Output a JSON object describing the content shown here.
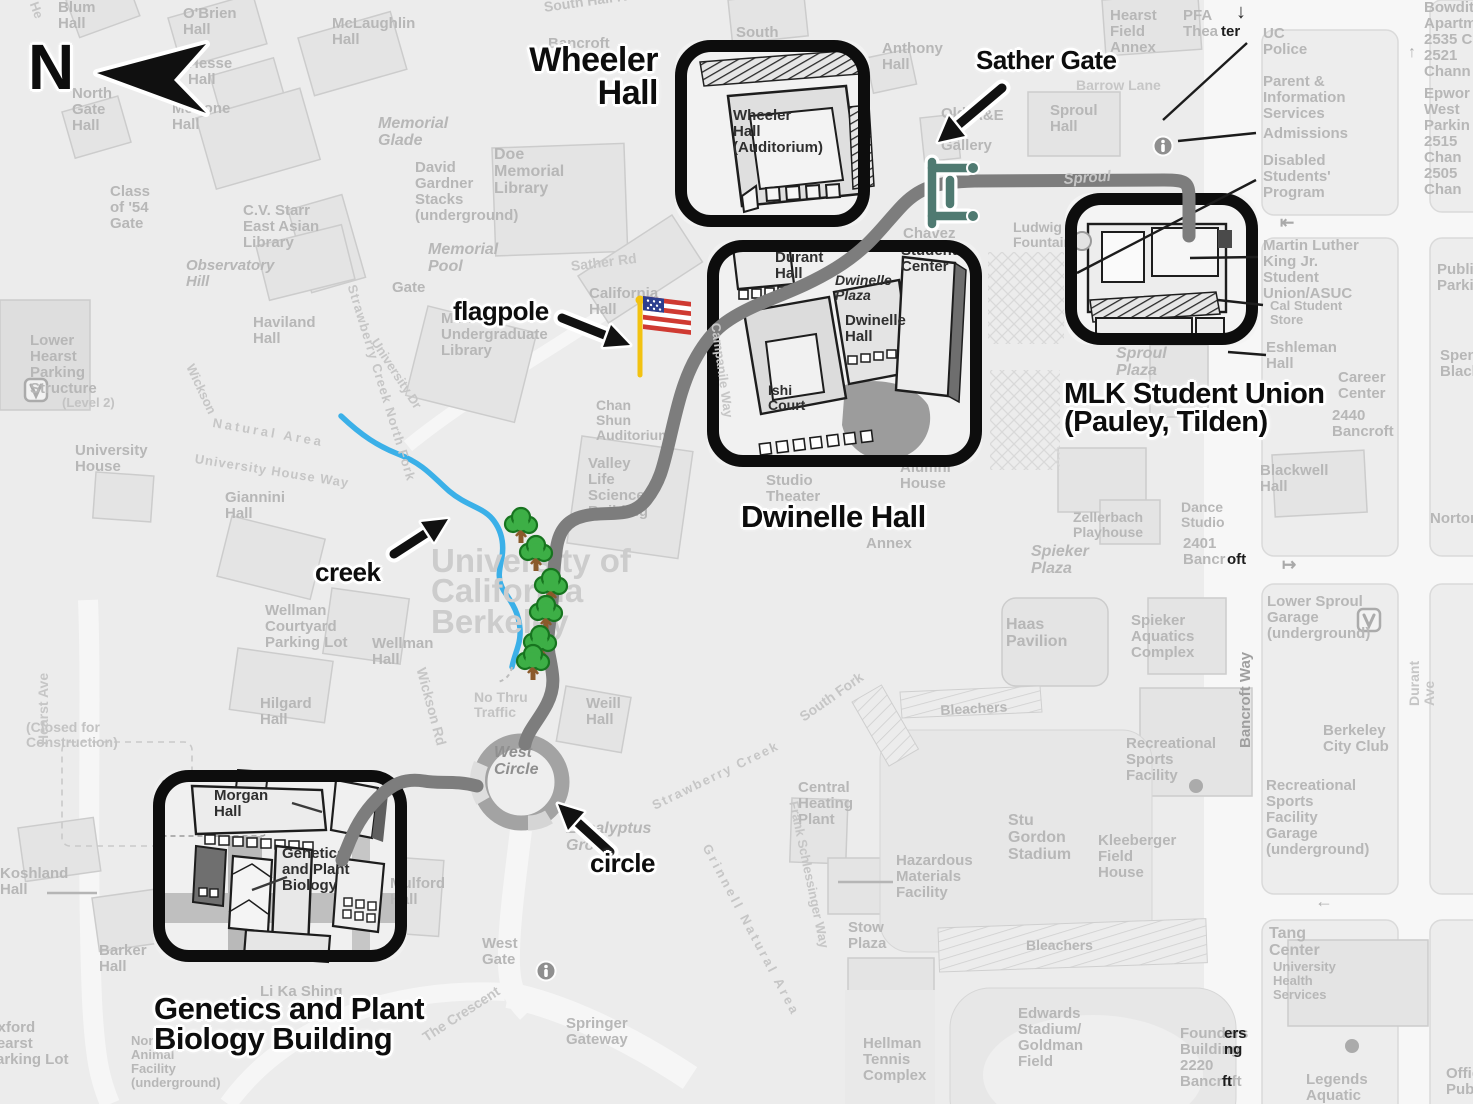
{
  "colors": {
    "bg": "#ececec",
    "label": "#b7b7b7",
    "annotation": "#0d0d0d",
    "highlight": "#0d0d0d",
    "route": "#7d7d7d",
    "creek": "#3bb0e8",
    "tree": "#3daf46",
    "tree_dark": "#17741f",
    "trunk": "#8a5a2b",
    "pole": "#f2c211",
    "flag_red": "#cf3a32",
    "flag_blue": "#2d3f8f",
    "gate": "#4f7a71"
  },
  "compass": {
    "letter": "N"
  },
  "annotations": [
    {
      "n": "compass-letter",
      "t": "N",
      "x": 28,
      "y": 36,
      "s": 64
    },
    {
      "n": "wheeler-hall-label",
      "t": "Wheeler\nHall",
      "x": 658,
      "y": 44,
      "s": 34,
      "a": "r"
    },
    {
      "n": "sather-gate-label",
      "t": "Sather Gate",
      "x": 976,
      "y": 48,
      "s": 26
    },
    {
      "n": "flagpole-label",
      "t": "flagpole",
      "x": 453,
      "y": 299,
      "s": 26
    },
    {
      "n": "mlk-student-union-label",
      "t": "MLK Student Union\n(Pauley, Tilden)",
      "x": 1064,
      "y": 380,
      "s": 29
    },
    {
      "n": "dwinelle-hall-label",
      "t": "Dwinelle Hall",
      "x": 741,
      "y": 502,
      "s": 31
    },
    {
      "n": "creek-label",
      "t": "creek",
      "x": 315,
      "y": 560,
      "s": 26
    },
    {
      "n": "circle-label",
      "t": "circle",
      "x": 590,
      "y": 851,
      "s": 26
    },
    {
      "n": "genetics-building-label",
      "t": "Genetics and Plant\nBiology Building",
      "x": 154,
      "y": 994,
      "s": 31
    }
  ],
  "highlight_boxes": [
    {
      "name": "wheeler-hall-box",
      "x": 675,
      "y": 40,
      "w": 195,
      "h": 187
    },
    {
      "name": "dwinelle-hall-box",
      "x": 707,
      "y": 240,
      "w": 275,
      "h": 227
    },
    {
      "name": "mlk-student-union-box",
      "x": 1065,
      "y": 193,
      "w": 193,
      "h": 152
    },
    {
      "name": "genetics-plant-biology-box",
      "x": 153,
      "y": 770,
      "w": 254,
      "h": 192
    }
  ],
  "map_labels": [
    {
      "t": "He",
      "x": 40,
      "y": 0,
      "r": 70,
      "s": 13,
      "c": "#c6c6c6"
    },
    {
      "t": "Blum\nHall",
      "x": 58,
      "y": 0
    },
    {
      "t": "O'Brien\nHall",
      "x": 183,
      "y": 6
    },
    {
      "t": "McLaughlin\nHall",
      "x": 332,
      "y": 16
    },
    {
      "t": "Hesse\nHall",
      "x": 188,
      "y": 56
    },
    {
      "t": "North\nGate\nHall",
      "x": 72,
      "y": 86
    },
    {
      "t": "McCone\nHall",
      "x": 172,
      "y": 101
    },
    {
      "t": "Class\nof '54\nGate",
      "x": 110,
      "y": 184
    },
    {
      "t": "C.V. Starr\nEast Asian\nLibrary",
      "x": 243,
      "y": 203
    },
    {
      "t": "Observatory\nHill",
      "x": 186,
      "y": 258,
      "i": 1
    },
    {
      "t": "Memorial\nGlade",
      "x": 378,
      "y": 115,
      "i": 1,
      "s": 16
    },
    {
      "t": "David\nGardner\nStacks\n(underground)",
      "x": 415,
      "y": 160
    },
    {
      "t": "Memorial\nPool",
      "x": 428,
      "y": 241,
      "i": 1,
      "s": 16
    },
    {
      "t": "South Hall Rd",
      "x": 543,
      "y": 0,
      "r": -8,
      "s": 14,
      "c": "#c2c2c2"
    },
    {
      "t": "Bancroft",
      "x": 548,
      "y": 36
    },
    {
      "t": "South",
      "x": 736,
      "y": 25
    },
    {
      "t": "Anthony\nHall",
      "x": 882,
      "y": 41
    },
    {
      "t": "Old\nArt\nGallery",
      "x": 941,
      "y": 106
    },
    {
      "t": "A&E",
      "x": 972,
      "y": 108
    },
    {
      "t": "Sproul\nHall",
      "x": 1050,
      "y": 103
    },
    {
      "t": "Barrow Lane",
      "x": 1076,
      "y": 78,
      "s": 14,
      "c": "#c6c6c6"
    },
    {
      "t": "Hearst\nField\nAnnex",
      "x": 1110,
      "y": 8
    },
    {
      "t": "PFA\nThea",
      "x": 1183,
      "y": 8
    },
    {
      "t": "ter",
      "x": 1221,
      "y": 24,
      "c": "#1c1c1c"
    },
    {
      "t": "↓",
      "x": 1236,
      "y": 2,
      "s": 20,
      "c": "#2a2a2a"
    },
    {
      "t": "UC\nPolice",
      "x": 1263,
      "y": 26
    },
    {
      "t": "Parent &\nInformation\nServices",
      "x": 1263,
      "y": 74
    },
    {
      "t": "Admissions",
      "x": 1263,
      "y": 126
    },
    {
      "t": "Disabled\nStudents'\nProgram",
      "x": 1263,
      "y": 153
    },
    {
      "t": "⇤",
      "x": 1280,
      "y": 214,
      "s": 17,
      "c": "#a9a9a9"
    },
    {
      "t": "Martin Luther\nKing Jr.\nStudent\nUnion/ASUC",
      "x": 1263,
      "y": 238
    },
    {
      "t": "Cal Student\nStore",
      "x": 1270,
      "y": 299,
      "s": 13
    },
    {
      "t": "Eshleman\nHall",
      "x": 1266,
      "y": 340
    },
    {
      "t": "Career\nCenter",
      "x": 1338,
      "y": 370
    },
    {
      "t": "2440\nBancroft",
      "x": 1332,
      "y": 408
    },
    {
      "t": "Blackwell\nHall",
      "x": 1260,
      "y": 463
    },
    {
      "t": "Norton",
      "x": 1430,
      "y": 511
    },
    {
      "t": "Dance\nStudio",
      "x": 1181,
      "y": 500,
      "s": 14
    },
    {
      "t": "2401\nBancr",
      "x": 1183,
      "y": 536
    },
    {
      "t": "oft",
      "x": 1227,
      "y": 552,
      "c": "#1c1c1c"
    },
    {
      "t": "↦",
      "x": 1282,
      "y": 556,
      "s": 17,
      "c": "#a9a9a9"
    },
    {
      "t": "Lower Sproul\nGarage\n(underground)",
      "x": 1267,
      "y": 594
    },
    {
      "t": "Durant Ave",
      "x": 1407,
      "y": 706,
      "r": -90,
      "s": 14,
      "c": "#c6c6c6"
    },
    {
      "t": "Berkeley\nCity Club",
      "x": 1323,
      "y": 723
    },
    {
      "t": "Recreational\nSports\nFacility\nGarage\n(underground)",
      "x": 1266,
      "y": 778
    },
    {
      "t": "Bancroft Way",
      "x": 1238,
      "y": 748,
      "r": -90,
      "s": 15,
      "c": "#9f9f9f"
    },
    {
      "t": "←",
      "x": 1315,
      "y": 892,
      "s": 18,
      "c": "#b0b0b0"
    },
    {
      "t": "Tang\nCenter",
      "x": 1269,
      "y": 925,
      "s": 16
    },
    {
      "t": "University\nHealth\nServices",
      "x": 1273,
      "y": 960,
      "s": 13
    },
    {
      "t": "Legends\nAquatic",
      "x": 1306,
      "y": 1072
    },
    {
      "t": "Offic\nPubli",
      "x": 1446,
      "y": 1066
    },
    {
      "t": "Founders\nBuilding\n2220\nBancroft",
      "x": 1180,
      "y": 1026
    },
    {
      "t": "ers\nng",
      "x": 1224,
      "y": 1026,
      "c": "#1c1c1c"
    },
    {
      "t": "ft",
      "x": 1222,
      "y": 1074,
      "c": "#1c1c1c"
    },
    {
      "t": "Bowditch\nApartme\n2535 Ch",
      "x": 1424,
      "y": 0
    },
    {
      "t": "↑",
      "x": 1408,
      "y": 44,
      "s": 16,
      "c": "#b0b0b0"
    },
    {
      "t": "2521\nChann",
      "x": 1424,
      "y": 48
    },
    {
      "t": "Epwor\nWest\nParkin",
      "x": 1424,
      "y": 86
    },
    {
      "t": "2515\nChan",
      "x": 1424,
      "y": 134
    },
    {
      "t": "2505\nChan",
      "x": 1424,
      "y": 166
    },
    {
      "t": "Public\nParkin",
      "x": 1437,
      "y": 262
    },
    {
      "t": "Spens\nBlack",
      "x": 1440,
      "y": 348
    },
    {
      "t": "Sproul\nPlaza",
      "x": 1116,
      "y": 345,
      "i": 1,
      "s": 16
    },
    {
      "t": "Ludwig\nFountain",
      "x": 1013,
      "y": 220,
      "s": 14
    },
    {
      "t": "Chávez",
      "x": 903,
      "y": 226
    },
    {
      "t": "Zellerbach\nPlayhouse",
      "x": 1073,
      "y": 510,
      "s": 14
    },
    {
      "t": "Spieker\nPlaza",
      "x": 1031,
      "y": 543,
      "i": 1,
      "s": 16
    },
    {
      "t": "Haas\nPavilion",
      "x": 1006,
      "y": 616,
      "s": 16
    },
    {
      "t": "Spieker\nAquatics\nComplex",
      "x": 1131,
      "y": 613
    },
    {
      "t": "Recreational\nSports\nFacility",
      "x": 1126,
      "y": 736
    },
    {
      "t": "Kleeberger\nField\nHouse",
      "x": 1098,
      "y": 833
    },
    {
      "t": "Stu\nGordon\nStadium",
      "x": 1008,
      "y": 812,
      "s": 16
    },
    {
      "t": "Bleachers",
      "x": 940,
      "y": 703,
      "s": 14,
      "r": -3
    },
    {
      "t": "Bleachers",
      "x": 1026,
      "y": 938,
      "s": 14
    },
    {
      "t": "Central\nHeating\nPlant",
      "x": 798,
      "y": 780
    },
    {
      "t": "Stow\nPlaza",
      "x": 848,
      "y": 920
    },
    {
      "t": "Hazardous\nMaterials\nFacility",
      "x": 896,
      "y": 853
    },
    {
      "t": "Hellman\nTennis\nComplex",
      "x": 863,
      "y": 1036
    },
    {
      "t": "Edwards\nStadium/\nGoldman\nField",
      "x": 1018,
      "y": 1006
    },
    {
      "t": "South Fork",
      "x": 797,
      "y": 712,
      "r": -35,
      "s": 14,
      "c": "#c6c6c6"
    },
    {
      "t": "Frank Schlessinger Way",
      "x": 800,
      "y": 800,
      "r": 78,
      "s": 13,
      "c": "#c6c6c6"
    },
    {
      "t": "Grinnell Natural Area",
      "x": 712,
      "y": 842,
      "r": 62,
      "s": 13,
      "c": "#c6c6c6",
      "ls": 3
    },
    {
      "t": "Strawberry Creek",
      "x": 650,
      "y": 800,
      "r": -26,
      "s": 13,
      "c": "#c6c6c6",
      "ls": 2
    },
    {
      "t": "Eucalyptus\nGrove",
      "x": 566,
      "y": 820,
      "i": 1,
      "s": 16
    },
    {
      "t": "West\nGate",
      "x": 482,
      "y": 936
    },
    {
      "t": "Springer\nGateway",
      "x": 566,
      "y": 1016
    },
    {
      "t": "The Crescent",
      "x": 420,
      "y": 1032,
      "r": -33,
      "s": 14,
      "c": "#c6c6c6"
    },
    {
      "t": "West\nCircle",
      "x": 494,
      "y": 744,
      "i": 1,
      "s": 16,
      "c": "#8f8f8f"
    },
    {
      "t": "Weill\nHall",
      "x": 586,
      "y": 696
    },
    {
      "t": "No Thru\nTraffic",
      "x": 474,
      "y": 690,
      "s": 14,
      "c": "#c3c3c3"
    },
    {
      "t": "Wickson Rd",
      "x": 428,
      "y": 666,
      "r": 75,
      "s": 14,
      "c": "#c6c6c6"
    },
    {
      "t": "Wellman\nHall",
      "x": 372,
      "y": 636
    },
    {
      "t": "Wellman\nCourtyard\nParking Lot",
      "x": 265,
      "y": 603
    },
    {
      "t": "Hilgard\nHall",
      "x": 260,
      "y": 696
    },
    {
      "t": "Giannini\nHall",
      "x": 225,
      "y": 490
    },
    {
      "t": "University\nHouse",
      "x": 75,
      "y": 443
    },
    {
      "t": "University House Way",
      "x": 196,
      "y": 452,
      "r": 9,
      "s": 13,
      "c": "#c6c6c6",
      "ls": 1
    },
    {
      "t": "Lower\nHearst\nParking\nStructure",
      "x": 30,
      "y": 333
    },
    {
      "t": "(Level 2)",
      "x": 62,
      "y": 396,
      "s": 13,
      "c": "#c3c3c3"
    },
    {
      "t": "Strawberry Creek North Fork",
      "x": 358,
      "y": 283,
      "r": 73,
      "s": 13,
      "c": "#c6c6c6",
      "ls": 1
    },
    {
      "t": "Wickson",
      "x": 196,
      "y": 362,
      "r": 65,
      "s": 13,
      "c": "#c6c6c6"
    },
    {
      "t": "Natural Area",
      "x": 214,
      "y": 416,
      "r": 10,
      "s": 13,
      "c": "#c6c6c6",
      "ls": 3
    },
    {
      "t": "Haviland\nHall",
      "x": 253,
      "y": 315
    },
    {
      "t": "University Dr",
      "x": 380,
      "y": 336,
      "r": 57,
      "s": 13,
      "c": "#c6c6c6"
    },
    {
      "t": "Gate",
      "x": 392,
      "y": 280
    },
    {
      "t": "Sather Rd",
      "x": 570,
      "y": 259,
      "r": -7,
      "s": 14,
      "c": "#c6c6c6"
    },
    {
      "t": "California\nHall",
      "x": 589,
      "y": 286
    },
    {
      "t": "Moffitt\nUndergraduate\nLibrary",
      "x": 441,
      "y": 311
    },
    {
      "t": "Doe\nMemorial\nLibrary",
      "x": 494,
      "y": 146,
      "s": 16
    },
    {
      "t": "Chan\nShun\nAuditorium",
      "x": 596,
      "y": 398,
      "s": 14
    },
    {
      "t": "Valley\nLife\nSciences\nBuilding",
      "x": 588,
      "y": 456
    },
    {
      "t": "Studio\nTheater",
      "x": 766,
      "y": 473
    },
    {
      "t": "Annex",
      "x": 866,
      "y": 536
    },
    {
      "t": "Alumni\nHouse",
      "x": 900,
      "y": 460
    },
    {
      "t": "Koshland\nHall",
      "x": 0,
      "y": 866
    },
    {
      "t": "Barker\nHall",
      "x": 99,
      "y": 943
    },
    {
      "t": "(Closed for\nConstruction)",
      "x": 26,
      "y": 720,
      "s": 14,
      "c": "#c3c3c3"
    },
    {
      "t": "Oxford\nHearst\nParking Lot",
      "x": -14,
      "y": 1020
    },
    {
      "t": "Northwest\nAnimal\nFacility\n(underground)",
      "x": 131,
      "y": 1034,
      "s": 13
    },
    {
      "t": "Hearst Ave",
      "x": 36,
      "y": 745,
      "r": -90,
      "s": 14,
      "c": "#c6c6c6"
    },
    {
      "t": "Li Ka Shing",
      "x": 260,
      "y": 984
    },
    {
      "t": "Mulford\nHall",
      "x": 390,
      "y": 876
    },
    {
      "t": "University of\nCalifornia\nBerkeley",
      "x": 431,
      "y": 546,
      "s": 33,
      "c": "#cccccc",
      "lh": 0.92
    },
    {
      "t": "Wheeler\nHall\n(Auditorium)",
      "x": 733,
      "y": 108,
      "c": "#2f2f2f"
    },
    {
      "t": "Durant\nHall",
      "x": 775,
      "y": 250,
      "c": "#2f2f2f"
    },
    {
      "t": "Dwinelle\nPlaza",
      "x": 835,
      "y": 273,
      "c": "#2f2f2f",
      "i": 1,
      "s": 14
    },
    {
      "t": "Dwinelle\nHall",
      "x": 845,
      "y": 313,
      "c": "#2f2f2f"
    },
    {
      "t": "Ishi\nCourt",
      "x": 768,
      "y": 383,
      "c": "#2f2f2f",
      "s": 14
    },
    {
      "t": "Student\nCenter",
      "x": 901,
      "y": 243,
      "c": "#2f2f2f"
    },
    {
      "t": "Morgan\nHall",
      "x": 214,
      "y": 788,
      "c": "#2f2f2f"
    },
    {
      "t": "Genetics\nand Plant\nBiology",
      "x": 282,
      "y": 846,
      "c": "#2f2f2f"
    }
  ],
  "map_labels_top": [
    {
      "t": "Sproul",
      "x": 1063,
      "y": 172,
      "i": 1,
      "r": -4,
      "s": 15,
      "c": "#c6c6c6"
    },
    {
      "t": "Campanile Way",
      "x": 722,
      "y": 322,
      "r": 82,
      "s": 13,
      "c": "#c6c6c6"
    }
  ],
  "leader_lines": [
    {
      "x1": 1247,
      "y1": 43,
      "x2": 1163,
      "y2": 120
    },
    {
      "x1": 1256,
      "y1": 133,
      "x2": 1178,
      "y2": 141
    },
    {
      "x1": 1256,
      "y1": 180,
      "x2": 1077,
      "y2": 273
    },
    {
      "x1": 1258,
      "y1": 257,
      "x2": 1190,
      "y2": 258
    },
    {
      "x1": 1263,
      "y1": 305,
      "x2": 1218,
      "y2": 300
    },
    {
      "x1": 1266,
      "y1": 355,
      "x2": 1228,
      "y2": 352
    },
    {
      "x1": 47,
      "y1": 893,
      "x2": 97,
      "y2": 893,
      "c": "#b5b5b5"
    },
    {
      "x1": 287,
      "y1": 877,
      "x2": 252,
      "y2": 890,
      "c": "#3a3a3a"
    },
    {
      "x1": 893,
      "y1": 882,
      "x2": 838,
      "y2": 882,
      "c": "#b5b5b5"
    },
    {
      "x1": 322,
      "y1": 812,
      "x2": 292,
      "y2": 803,
      "c": "#3a3a3a"
    }
  ],
  "trees": [
    [
      521,
      526
    ],
    [
      536,
      554
    ],
    [
      551,
      587
    ],
    [
      546,
      614
    ],
    [
      540,
      644
    ],
    [
      533,
      663
    ]
  ],
  "info_icons": [
    [
      1163,
      146
    ],
    [
      546,
      971
    ]
  ],
  "parking_icons": [
    [
      36,
      390
    ],
    [
      1369,
      620
    ]
  ],
  "dots": [
    [
      1196,
      786
    ],
    [
      1352,
      1046
    ]
  ]
}
